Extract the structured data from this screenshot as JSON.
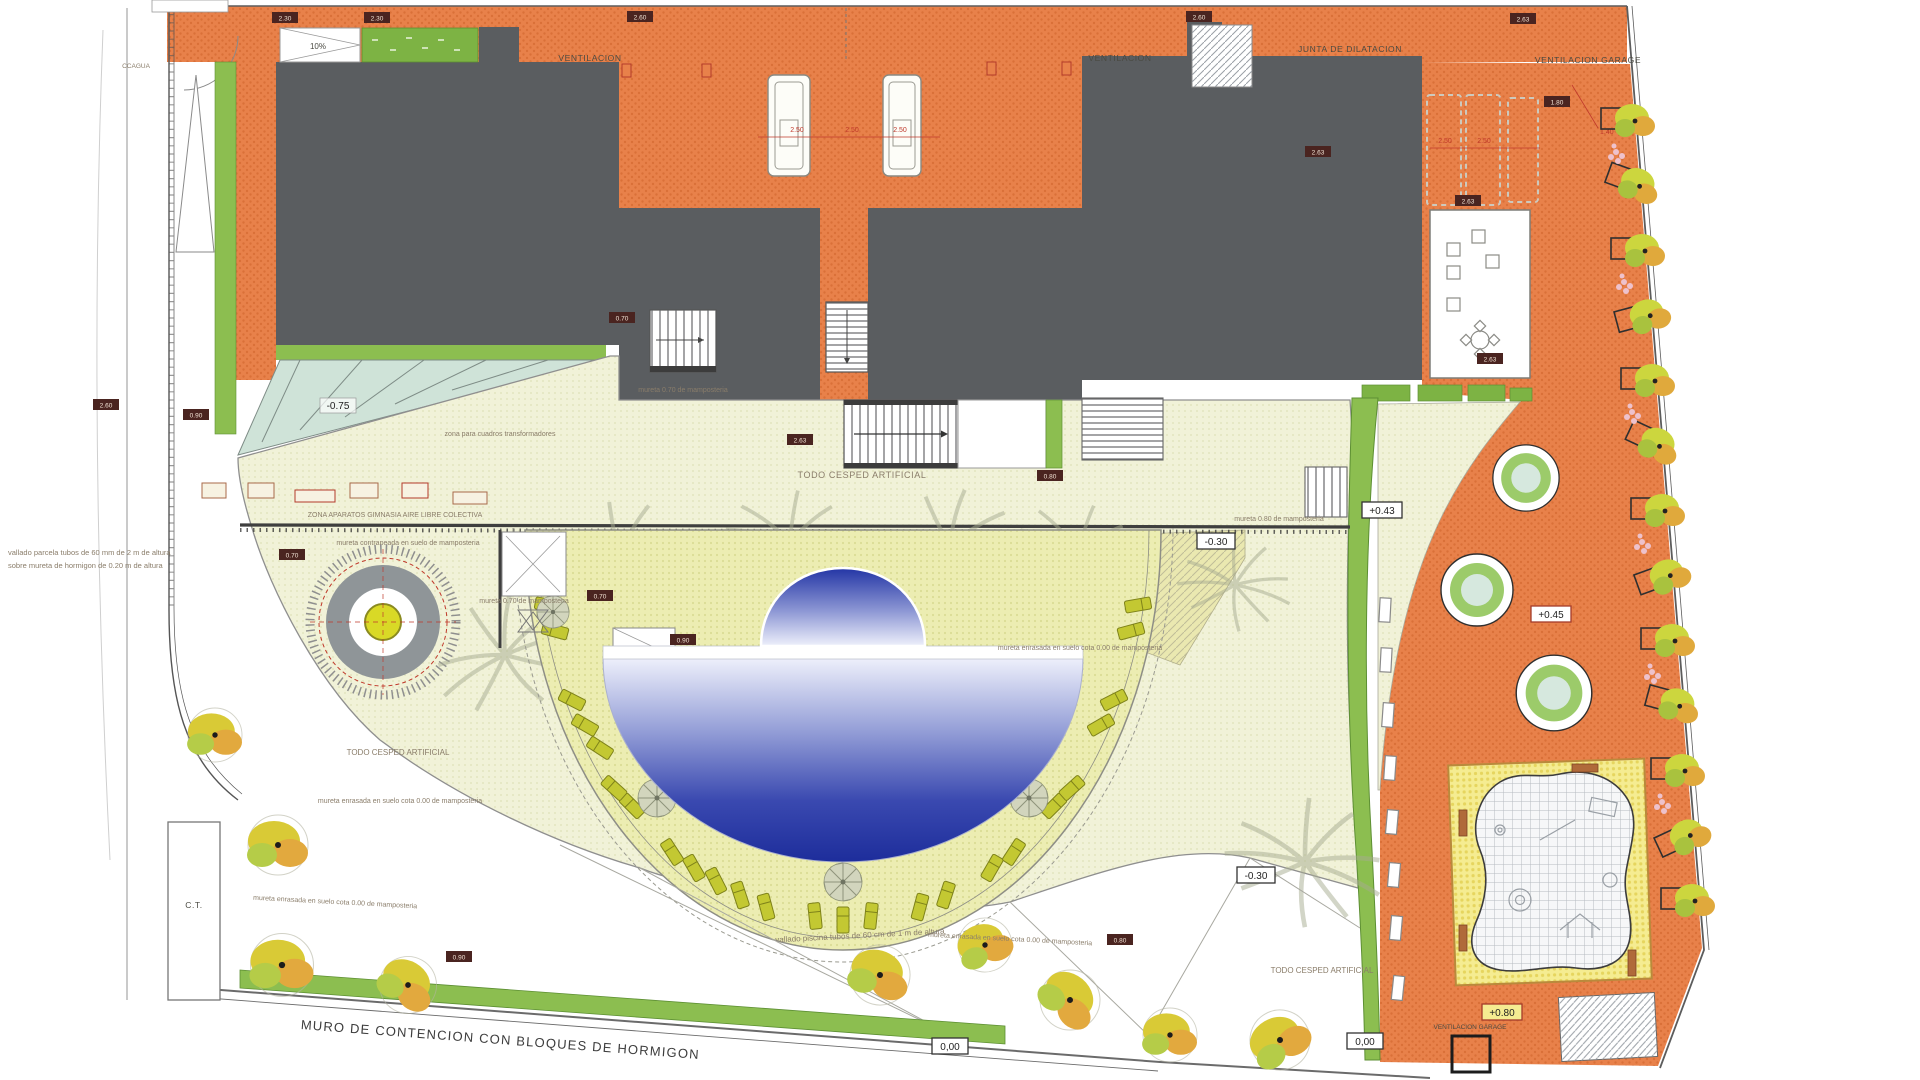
{
  "colors": {
    "terrace_orange": "#e8814a",
    "building_gray": "#5a5d60",
    "lawn_cream": "#f1f2d8",
    "deck_yellow": "#ecedb2",
    "pool_deep_blue": "#1d2d9b",
    "path_green": "#8cbe50",
    "teal_ramp": "#cfe3d8",
    "lounger_olive": "#c3c832",
    "playground_sand": "#f5ec91",
    "bench_brown": "#b06a3a",
    "dim_red": "#c0392b"
  },
  "labels": {
    "ccagua": "CCAGUA",
    "ventilacion": "VENTILACION",
    "junta_dilatacion": "JUNTA DE DILATACION",
    "ventilacion_garage": "VENTILACION GARAGE",
    "ramp_slope": "10%",
    "cesped": "TODO CESPED ARTIFICIAL",
    "zona_aparatos": "ZONA APARATOS GIMNASIA AIRE LIBRE COLECTIVA",
    "zona_cuadros": "zona para cuadros transformadores",
    "mureta_070": "mureta 0.70 de mamposteria",
    "mureta_080": "mureta 0.80 de mamposteria",
    "mureta_contrapeada": "mureta contrapeada en suelo de mamposteria",
    "mureta_enrasada": "mureta enrasada en suelo cota 0.00 de mamposteria",
    "vallado_piscina": "vallado piscina tubos de 60 cm de 1 m de altura",
    "vallado_parcela_1": "vallado parcela tubos de 60 mm de 2 m de altura",
    "vallado_parcela_2": "sobre mureta de hormigon de 0.20 m de altura",
    "muro": "MURO DE CONTENCION  CON BLOQUES DE HORMIGON",
    "ct": "C.T."
  },
  "levels": {
    "minus075": "-0.75",
    "minus030": "-0.30",
    "plus043": "+0.43",
    "plus045": "+0.45",
    "plus080": "+0.80",
    "zero": "0,00"
  },
  "dims": {
    "d230": "2.30",
    "d250": "2.50",
    "d263": "2.63",
    "d260": "2.60",
    "d140": "1.40",
    "d090": "0.90",
    "d080": "0.80",
    "d070": "0.70",
    "d180": "1.80"
  }
}
